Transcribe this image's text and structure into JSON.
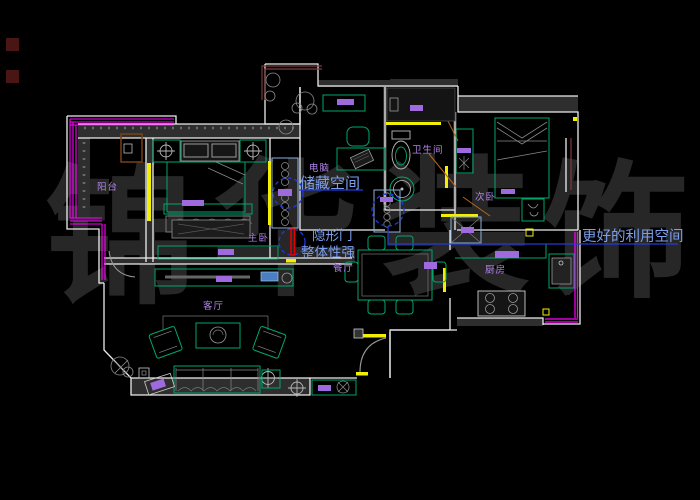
{
  "window": {
    "type": "cad-floorplan-viewport",
    "background": "#000000"
  },
  "watermark": {
    "color": "#272727",
    "characters": [
      {
        "char": "锦"
      },
      {
        "char": "华"
      },
      {
        "char": "装"
      },
      {
        "char": "饰"
      }
    ]
  },
  "rooms": {
    "balcony": {
      "label": "阳台"
    },
    "master_bedroom": {
      "label": "主卧"
    },
    "study": {
      "label": "电脑"
    },
    "bathroom": {
      "label": "卫生间"
    },
    "second_bedroom": {
      "label": "次卧"
    },
    "kitchen": {
      "label": "厨房"
    },
    "dining": {
      "label": "餐厅"
    },
    "living": {
      "label": "客厅"
    }
  },
  "annotations": {
    "storage": {
      "text": "储藏空间"
    },
    "hidden_door": {
      "line1": "隐形门",
      "line2": "整体性强"
    },
    "better_use": {
      "text": "更好的利用空间"
    },
    "text_color": "#7d9ff0",
    "leader_color": "#2438d8"
  },
  "palette": {
    "wall_line": "#ededed",
    "wall_fill": "#2e2e2e",
    "furniture_green": "#00a66a",
    "window_yellow": "#f2ef00",
    "railing_magenta": "#ff00ff",
    "label_purple": "#b184ea",
    "fixture_purple": "#9e6ade",
    "hidden_door_red": "#e80000",
    "door_swing_orange": "#b5651d",
    "highlight_blue": "#2438d8",
    "detail_gray": "#8a8a8a"
  }
}
